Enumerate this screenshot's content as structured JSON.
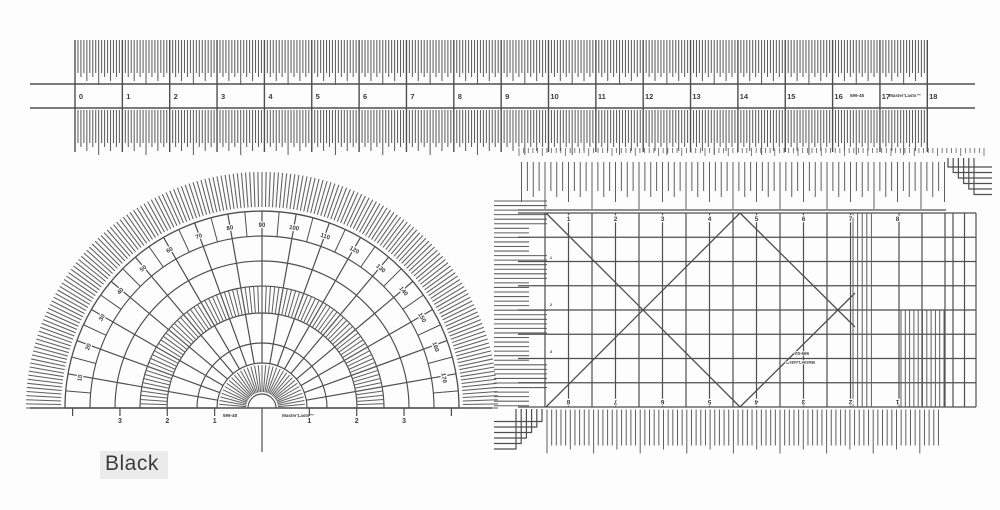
{
  "caption": {
    "text": "Black"
  },
  "colors": {
    "bg": "#fdfdfd",
    "ink": "#4e4e4e",
    "ink_light": "#5f5f5f",
    "text_ink": "#3c3c3c"
  },
  "ruler": {
    "numbers": [
      "0",
      "1",
      "2",
      "3",
      "4",
      "5",
      "6",
      "7",
      "8",
      "9",
      "10",
      "11",
      "12",
      "13",
      "14",
      "15",
      "16",
      "17",
      "18"
    ],
    "code": "599-48",
    "brand": "Master'Lasts™"
  },
  "protractor": {
    "degree_labels": [
      "10",
      "20",
      "30",
      "40",
      "50",
      "60",
      "70",
      "80",
      "90",
      "100",
      "110",
      "120",
      "130",
      "140",
      "150",
      "160",
      "170"
    ],
    "baseline_numbers_left": [
      "3",
      "2",
      "1"
    ],
    "baseline_numbers_right": [
      "1",
      "2",
      "3"
    ],
    "code": "599-48",
    "brand": "Master'Lasts™"
  },
  "grid": {
    "top_numbers": [
      "1",
      "2",
      "3",
      "4",
      "5",
      "6",
      "7",
      "8"
    ],
    "bottom_numbers": [
      "8",
      "7",
      "6",
      "5",
      "4",
      "3",
      "2",
      "1"
    ],
    "row_marks": [
      "1",
      "2",
      "3"
    ],
    "code": "599-02",
    "brand": "Master'Lasts™"
  }
}
